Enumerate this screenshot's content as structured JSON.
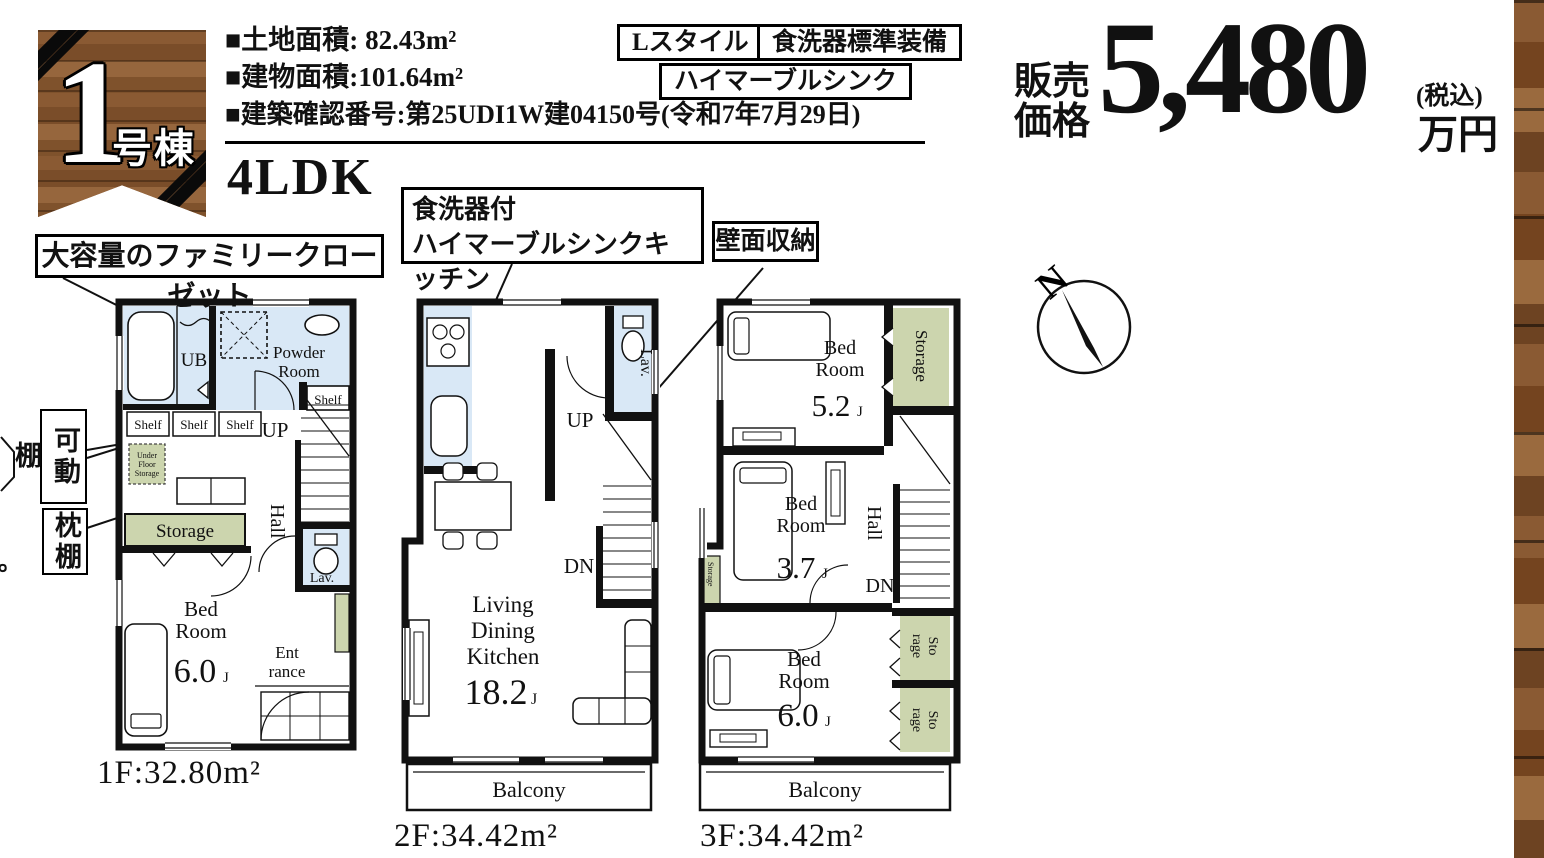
{
  "colors": {
    "wall_black": "#111111",
    "wet_area_blue": "#d9e8f6",
    "storage_green": "#ccd5ae",
    "wood_brown": "#845530"
  },
  "badge": {
    "number": "1",
    "label": "号棟"
  },
  "specs": {
    "items": [
      {
        "label": "■土地面積:",
        "value": " 82.43m²"
      },
      {
        "label": "■建物面積:",
        "value": "101.64m²"
      },
      {
        "label": "■建築確認番号:",
        "value": "第25UDI1W建04150号(令和7年7月29日)"
      }
    ],
    "layout": "4LDK"
  },
  "tags": [
    {
      "label": "Lスタイル"
    },
    {
      "label": "食洗器標準装備"
    },
    {
      "label": "ハイマーブルシンク"
    }
  ],
  "price": {
    "label_top": "販売",
    "label_bottom": "価格",
    "amount": "5,480",
    "tax_note": "(税込)",
    "unit": "万円"
  },
  "callouts": {
    "family_closet": "大容量のファミリークローゼット",
    "kitchen_line1": "食洗器付",
    "kitchen_line2": "ハイマーブルシンクキッチン",
    "wall_storage": "壁面収納"
  },
  "side_labels": {
    "movable_shelf": "可動棚",
    "pillow_shelf": "枕棚",
    "edge_fragment": "。"
  },
  "compass": {
    "north": "N"
  },
  "floor1": {
    "area": "1F:32.80m²",
    "ub": "UB",
    "powder_line1": "Powder",
    "powder_line2": "Room",
    "shelf": "Shelf",
    "up": "UP",
    "under_floor_line1": "Under",
    "under_floor_line2": "Floor",
    "under_floor_line3": "Storage",
    "storage": "Storage",
    "hall": "Hall",
    "bed_line1": "Bed",
    "bed_line2": "Room",
    "bed_size": "6.0",
    "bed_size_unit": "J",
    "lav": "Lav.",
    "entrance_line1": "Ent",
    "entrance_line2": "rance"
  },
  "floor2": {
    "area": "2F:34.42m²",
    "lav": "Lav.",
    "up": "UP",
    "dn": "DN",
    "ldk_line1": "Living",
    "ldk_line2": "Dining",
    "ldk_line3": "Kitchen",
    "ldk_size": "18.2",
    "ldk_size_unit": "J",
    "balcony": "Balcony"
  },
  "floor3": {
    "area": "3F:34.42m²",
    "bed_line1": "Bed",
    "bed_line2": "Room",
    "bed1_size": "5.2",
    "bed2_size": "3.7",
    "bed3_size": "6.0",
    "size_unit": "J",
    "storage": "Storage",
    "sto": "Sto",
    "rage": "rage",
    "hall": "Hall",
    "dn": "DN",
    "balcony": "Balcony"
  }
}
